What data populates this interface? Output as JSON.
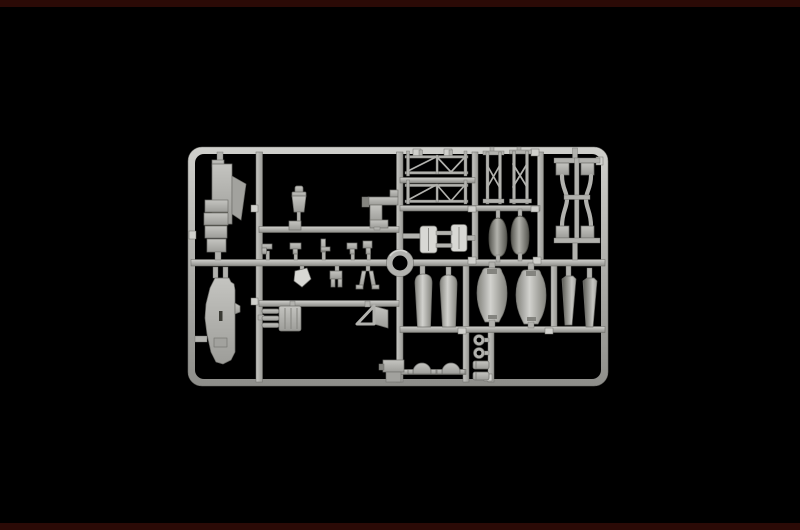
{
  "scene": {
    "description": "Product photograph of a light gray injection-molded plastic model kit sprue (parts tree) centered on a black background",
    "subject": "model-kit-sprue",
    "text_visible": "none"
  },
  "palette": {
    "bg": "#000000",
    "band": "#2b0a06",
    "rail": "#b2b2ae",
    "rail_light": "#d0d0cc",
    "rail_dark": "#8e8e8a",
    "part": "#b5b5b1",
    "part_light": "#d8d8d4",
    "part_mid": "#a2a29e",
    "part_dark": "#84847f",
    "deep": "#57574f",
    "outline": "#6f6f6b"
  },
  "sprue": {
    "frame": {
      "x": 188,
      "y": 147,
      "width": 420,
      "height": 239,
      "corner_radius": 14,
      "rail_thickness": 7
    },
    "center_ring": {
      "cx": 400,
      "cy": 263,
      "outer_r": 13.5,
      "inner_r": 7.5
    },
    "parts": [
      {
        "name": "cockpit-floor-assembly",
        "area": "top-left"
      },
      {
        "name": "hull-half",
        "area": "bottom-left"
      },
      {
        "name": "pilot-figure",
        "area": "upper-middle"
      },
      {
        "name": "mount-bracket",
        "area": "upper-middle"
      },
      {
        "name": "control-levers",
        "count": 5,
        "area": "middle-strip"
      },
      {
        "name": "small-fittings",
        "count": 3,
        "area": "middle-strip-lower"
      },
      {
        "name": "engine-block-with-pipes",
        "area": "lower-middle"
      },
      {
        "name": "windscreen-frame",
        "area": "lower-middle"
      },
      {
        "name": "junction-box",
        "area": "bottom-middle"
      },
      {
        "name": "rigging-strut-rows",
        "count": 2,
        "area": "top-right"
      },
      {
        "name": "x-braced-ladder-struts",
        "count": 2,
        "area": "top-right"
      },
      {
        "name": "teardrop-float-tips",
        "count": 2,
        "area": "mid-right"
      },
      {
        "name": "radiator-pair",
        "area": "mid-right"
      },
      {
        "name": "chassis-frame",
        "area": "far-right"
      },
      {
        "name": "float-halves",
        "count": 2,
        "area": "lower-middle-right"
      },
      {
        "name": "pontoon-halves",
        "count": 2,
        "area": "lower-right"
      },
      {
        "name": "tail-cones",
        "count": 2,
        "area": "lower-far-right"
      },
      {
        "name": "dome-caps",
        "count": 2,
        "area": "bottom-right"
      },
      {
        "name": "tow-rings",
        "count": 2,
        "area": "bottom-right"
      },
      {
        "name": "cylinder-blocks",
        "count": 2,
        "area": "bottom-right"
      }
    ]
  }
}
